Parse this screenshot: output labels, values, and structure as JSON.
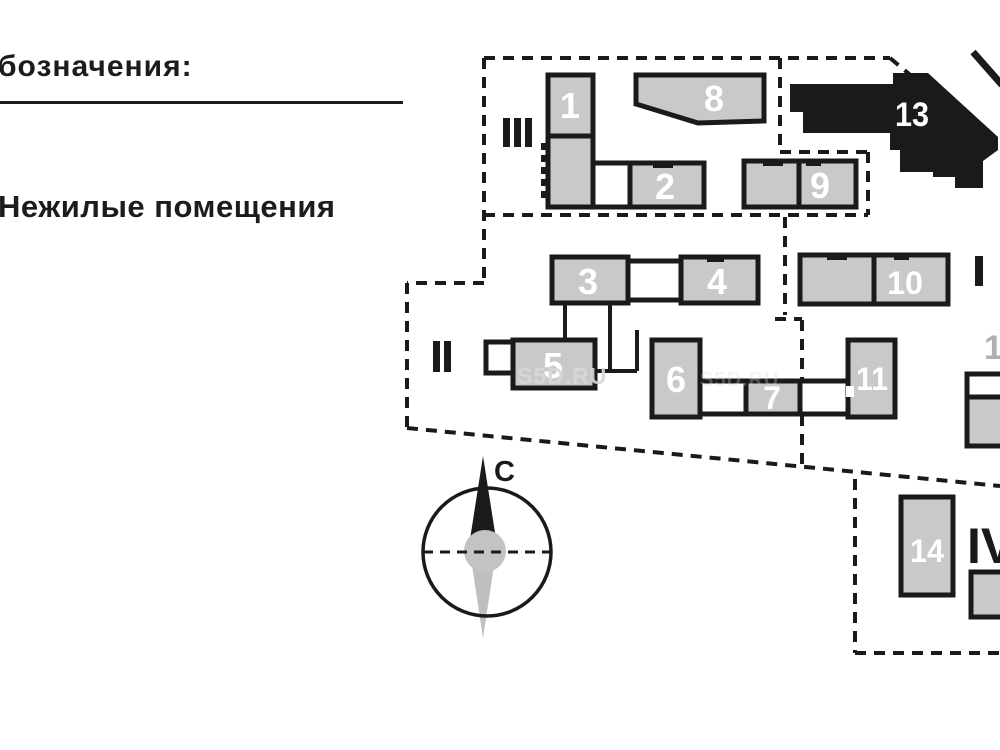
{
  "legend": {
    "title": "бозначения:",
    "item_nonresidential": "Нежилые помещения"
  },
  "compass": {
    "north_label": "С"
  },
  "watermark": {
    "text": "S5D.RU"
  },
  "plan": {
    "building_labels": {
      "b1": "1",
      "b2": "2",
      "b3": "3",
      "b4": "4",
      "b5": "5",
      "b6": "6",
      "b7": "7",
      "b8": "8",
      "b9": "9",
      "b10": "10",
      "b11": "11",
      "b13": "13",
      "b14": "14"
    },
    "block_markers": {
      "i": "I",
      "ii": "II",
      "iii": "III",
      "iv": "IV"
    },
    "edge_label": "1"
  },
  "colors": {
    "outline": "#1a1a1a",
    "building_fill": "#c9c9c9",
    "building_13_fill": "#1a1a1a",
    "number_color": "#ffffff",
    "watermark_color": "#d8d8d8",
    "edge_label_color": "#b0b0b0",
    "compass_hub": "#c3c3c3",
    "compass_south": "#bfbfbf"
  }
}
